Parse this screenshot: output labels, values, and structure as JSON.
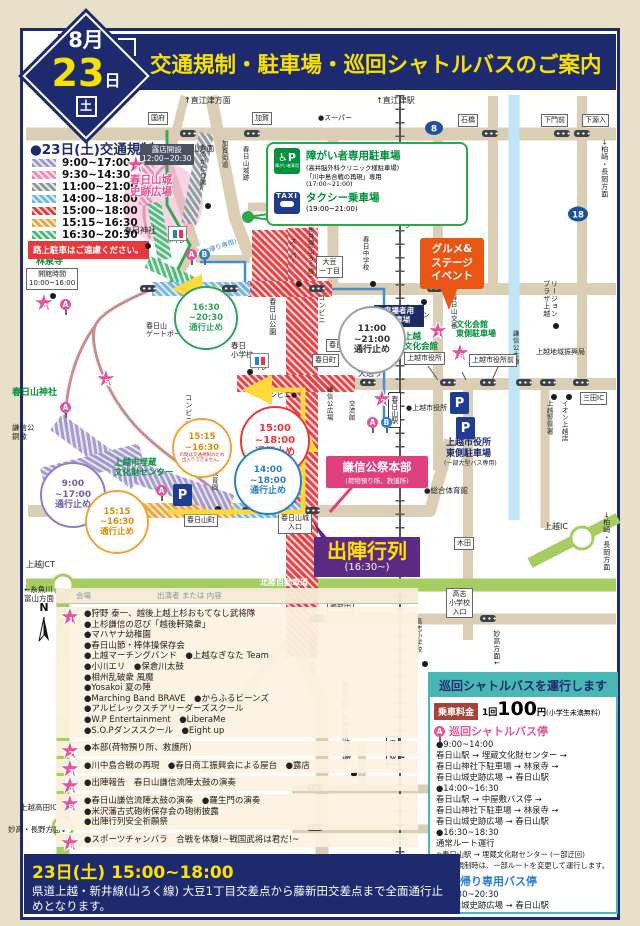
{
  "badge": {
    "month": "8月",
    "day": "23",
    "day_unit": "日",
    "dow": "土"
  },
  "title": "交通規制・駐車場・巡回シャトルバスのご案内",
  "legend": {
    "title": "●23日(土)交通規制",
    "items": [
      {
        "time": "9:00~17:00",
        "color": "#9f94cc"
      },
      {
        "time": "9:30~14:30",
        "color": "#f08ab4"
      },
      {
        "time": "11:00~21:00",
        "color": "#8f959e"
      },
      {
        "time": "14:00~18:00",
        "color": "#6fb5e8"
      },
      {
        "time": "15:00~18:00",
        "color": "#e8383d"
      },
      {
        "time": "15:15~16:30",
        "color": "#f0a33a"
      },
      {
        "time": "16:30~20:30",
        "color": "#4db578"
      }
    ],
    "warning": "路上駐車はご遠慮ください。"
  },
  "map": {
    "route8": "8",
    "route18": "18",
    "stars": [
      "1",
      "2",
      "3",
      "4",
      "5",
      "6"
    ],
    "icons": {
      "parking": "P",
      "stop_a": "A",
      "stop_b": "B",
      "north": "N"
    },
    "labels": [
      "↑直江津方面",
      "↑直江津駅",
      "●スーパー",
      "←糸魚川・富山方面",
      "春日神社",
      "上越JCT",
      "上越高田IC",
      "妙高・長野方面↓",
      "←糸魚川・\n富山方面",
      "上越IC",
      "●総合体育館",
      "●上越市役所",
      "上越市役所\n東側駐車場",
      "(一部大型バス専用)",
      "来場者用\n駐車場",
      "謙信公\n大通り",
      "オール\nシーズン\nプール",
      "北陸自動車道",
      "上信越自動車道",
      "コンビニ",
      "コンビニ●",
      "コンビニ",
      "春日\n小学校",
      "春日山公園",
      "春日山\nゲートボール場",
      "謙信公\n銅像",
      "林泉寺",
      "春日山神社",
      "上越市埋蔵\n文化財センター",
      "上越\n文化会館",
      "文化会館\n東側駐車場",
      "春日山城\n史跡広場",
      "春日保育園",
      "謙信公広場",
      "交流館",
      "春日山交番",
      "リージョン\nプラザ上越",
      "謙信公大橋",
      "上越地域振興局",
      "上越警察署",
      "イオン上越店",
      "妙高はねうまライン",
      "県道上越・新井線(山ろく線)",
      "県道上越・新井線(山ろく線)",
      "上越教育大学",
      "高志小学校",
      "妙高方面↓",
      "浄興寺",
      "スーパー",
      "春日中学校",
      "加賀街道",
      "春日山城跡",
      "ものがたり館",
      "→柏崎・長岡方面",
      "→柏崎・長岡方面",
      "(お帰り専用)",
      "トイレ",
      "トイレ"
    ],
    "boxes": [
      "国府",
      "加賀",
      "石橋",
      "下門前",
      "下源入",
      "大豆\n一丁目",
      "春日山町三",
      "春日町",
      "上越市役所",
      "上越市役所前",
      "三田IC",
      "木田",
      "藤新田",
      "高志\n小学校\n入口",
      "春日山城\n入口",
      "春日山町",
      "開館時間\n10:00~16:00",
      "露店開設\n12:00~20:30",
      "高田駅",
      "春日山駅"
    ],
    "circles": [
      {
        "t": "11:00\n~21:00\n通行止め"
      },
      {
        "t": "16:30\n~20:30\n通行止め"
      },
      {
        "t": "15:00\n~18:00\n通行止め"
      },
      {
        "t": "14:00\n~18:00\n通行止め"
      },
      {
        "t": "9:00\n~17:00\n通行止め"
      },
      {
        "t": "15:15\n~16:30\n通行止め"
      },
      {
        "t": "15:15\n~16:30",
        "note": "の間は交通規制のため\n出入りできません。"
      }
    ]
  },
  "parking_box": {
    "title1": "障がい者専用駐車場",
    "sub1": "(高井脳外科クリニック様駐車場)",
    "sub2": "「川中島合戦の再現」専用",
    "sub3": "(17:00~21:00)",
    "title2": "タクシー乗車場",
    "sub4": "(19:00~21:00)",
    "icon1_caption": "障がい者専用",
    "taxi": "TAXI"
  },
  "gourmet": "グルメ&\nステージ\nイベント",
  "hq": {
    "line1": "謙信公祭本部",
    "line2": "(荷物預り所、救護所)"
  },
  "parade": {
    "line1": "出陣行列",
    "line2": "(16:30~)"
  },
  "program": {
    "header_venue": "会場",
    "header_content": "出演者 または 内容",
    "rows": [
      {
        "lines": [
          "●狩野 泰一、越後上越上杉おもてなし武将隊",
          "●上杉謙信の忍び「越後軒猿衆」",
          "●マハヤナ幼稚園",
          "●春日山節・棒体操保存会",
          "●上越マーチングバンド　●上越なぎなた Team",
          "●小川エリ　●保倉川太鼓",
          "●相州乱破衆 風魔",
          "●Yosakoi 夏の陣",
          "●Marching Band BRAVE　●からふるビーンズ",
          "●アルビレックスチアリーダーズスクール",
          "●W.P Entertainment　●LiberaMe",
          "●S.O.Pダンススクール　●Eight up"
        ]
      },
      {
        "lines": [
          "●本部(荷物預り所、救護所)"
        ]
      },
      {
        "lines": [
          "●川中島合戦の再現　●春日商工振興会による屋台　●露店"
        ]
      },
      {
        "lines": [
          "●出陣報告　春日山謙信流陣太鼓の演奏"
        ]
      },
      {
        "lines": [
          "●春日山謙信流陣太鼓の演奏　●羅生門の演奏",
          "●米沢藩古式砲術保存会の砲術披露",
          "●出陣行列安全祈願祭"
        ]
      },
      {
        "lines": [
          "●スポーツチャンバラ　合戦を体験!~戦国武将は君だ!~"
        ]
      }
    ]
  },
  "closure": {
    "heading": "23日(土) 15:00~18:00",
    "body": "県道上越・新井線(山ろく線) 大豆1丁目交差点から藤新田交差点まで全面通行止めとなります。"
  },
  "shuttle": {
    "title": "巡回シャトルバスを運行します",
    "fare_label": "乗車料金",
    "fare_pre": "1回",
    "fare_amount": "100",
    "fare_unit": "円",
    "fare_note": "(小学生未満無料)",
    "stop_a": "巡回シャトルバス停",
    "stop_b": "お帰り専用バス停",
    "a_lines": [
      "●9:00~14:00",
      "春日山駅 → 埋蔵文化財センター →",
      "春日山神社下駐車場 → 林泉寺 →",
      "春日山城史跡広場 → 春日山駅",
      "●14:00~16:30",
      "春日山駅 → 中屋敷バス停 →",
      "春日山神社下駐車場 → 林泉寺 →",
      "春日山城史跡広場 → 春日山駅",
      "●16:30~18:30",
      "通常ルート運行",
      "※春日山駅 → 埋蔵文化財センター (一部迂回)",
      "※交通規制時は、一部ルートを変更して運行します。"
    ],
    "b_lines": [
      "●19:30~20:30",
      "春日山城史跡広場 → 春日山駅"
    ]
  }
}
